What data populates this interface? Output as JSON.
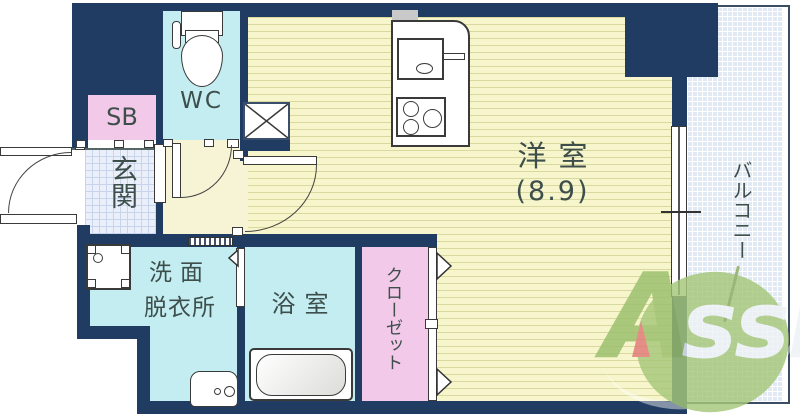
{
  "floorplan": {
    "rooms": {
      "main": {
        "label": "洋室",
        "size": "(8.9)"
      },
      "balcony": {
        "label": "バルコニー"
      },
      "wc": {
        "label": "WC"
      },
      "sb": {
        "label": "SB"
      },
      "genkan": {
        "label": "玄関"
      },
      "washroom": {
        "line1": "洗面",
        "line2": "脱衣所"
      },
      "bathroom": {
        "label": "浴室"
      },
      "closet": {
        "label": "クローゼット"
      }
    },
    "watermark": {
      "part1": "A",
      "part2": "ssist"
    },
    "colors": {
      "wall_navy": "#203c62",
      "flooring_yellow": "#f6f5cb",
      "flooring_stripe": "#d9d89e",
      "wet_area_cyan": "#c3edf1",
      "storage_pink": "#f3c9e9",
      "balcony_blue": "#e1eaf4",
      "entry_tile_blue": "#eaeff9",
      "logo_green": "#a6c779",
      "logo_red": "#e17878",
      "label_ink": "#3d4e4b"
    }
  }
}
